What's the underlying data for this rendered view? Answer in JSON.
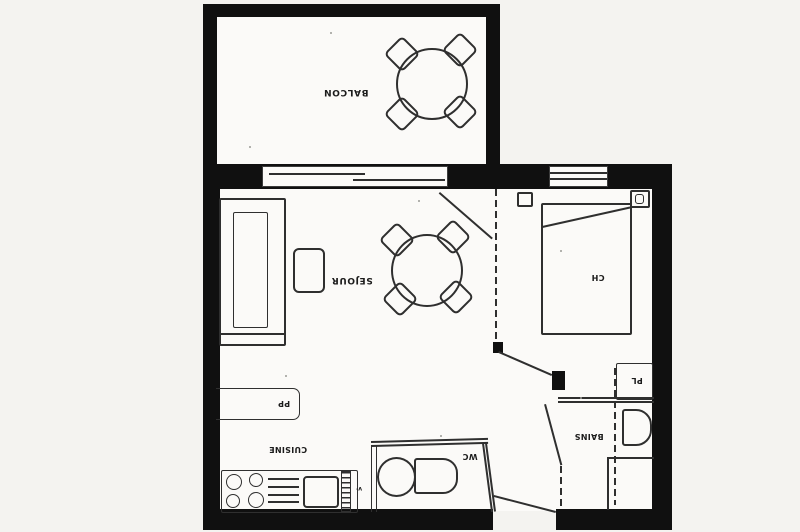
{
  "drawing": {
    "type": "apartment-floor-plan-scan",
    "labels": {
      "balcony": "BALCON",
      "living_room": "SEJOUR",
      "bedroom": "CH",
      "closet": "PL",
      "bathroom": "BAINS",
      "wc": "WC",
      "kitchen": "CUISINE",
      "entry_cupboard": "PP",
      "counter_mark": "v·"
    },
    "colors": {
      "wall": "#101010",
      "line": "#2f2f2f",
      "paper": "#f4f3f0",
      "floor": "#fbfaf8"
    }
  }
}
